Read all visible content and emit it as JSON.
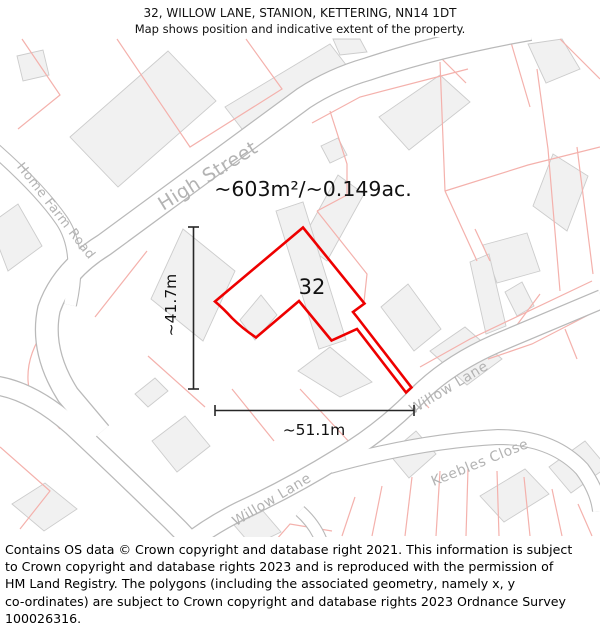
{
  "title": {
    "line1": "32, WILLOW LANE, STANION, KETTERING, NN14 1DT",
    "line2": "Map shows position and indicative extent of the property."
  },
  "map": {
    "area_label": "~603m²/~0.149ac.",
    "property_number": "32",
    "dim_height": "~41.7m",
    "dim_width": "~51.1m",
    "streets": {
      "high_street": "High Street",
      "home_farm_road": "Home Farm Road",
      "willow_lane_upper": "Willow Lane",
      "willow_lane_lower": "Willow Lane",
      "keebles_close": "Keebles Close"
    },
    "colors": {
      "plot_outline": "#ee0000",
      "parcel_line": "#f4b1ac",
      "road_line": "#b9b9b9",
      "building_fill": "#f1f1f1",
      "building_stroke": "#cccccc",
      "street_label": "#b3b3b3"
    }
  },
  "footer": {
    "lines": [
      "Contains OS data © Crown copyright and database right 2021. This information is subject",
      "to Crown copyright and database rights 2023 and is reproduced with the permission of",
      "HM Land Registry. The polygons (including the associated geometry, namely x, y",
      "co-ordinates) are subject to Crown copyright and database rights 2023 Ordnance Survey",
      "100026316."
    ]
  }
}
